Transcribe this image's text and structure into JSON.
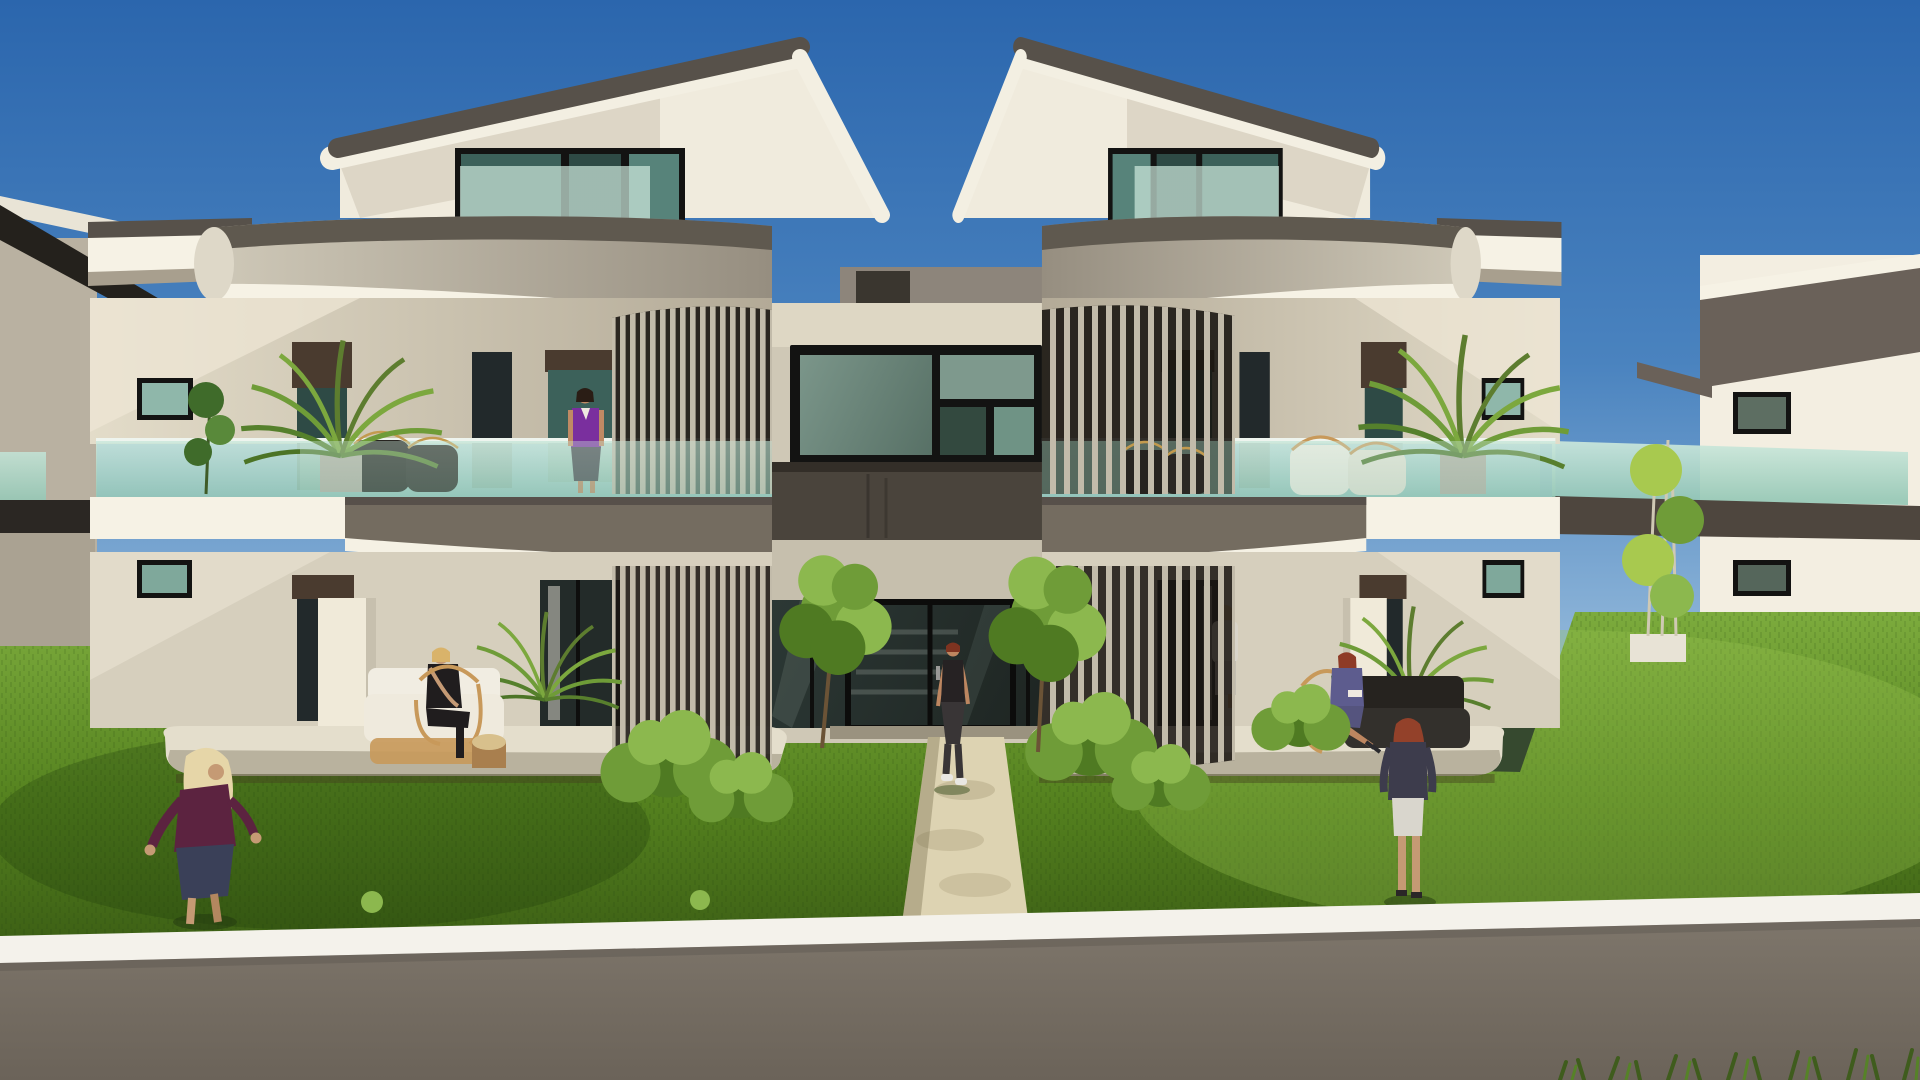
{
  "image": {
    "type": "architectural-3d-rendering",
    "subject": "Modern twin-unit two-storey apartment building with curved balcony bands, vertical slat screens, teal glass balustrades, front lawn, central walkway and boundary wall",
    "time_of_day": "sunny daytime, clear blue sky, sun from the left",
    "view": "front elevation from street behind low boundary wall"
  },
  "colors": {
    "sky_top": "#2b66ad",
    "sky_mid": "#4a83bf",
    "sky_horizon": "#92b8da",
    "roof_dark": "#57514a",
    "roof_shadow_dark": "#24211c",
    "band_light": "#d8d2c1",
    "band_shade": "#968e80",
    "fascia_white": "#f6f2e5",
    "attic_wall": "#f0ebdd",
    "wall_light": "#e3dcc9",
    "wall_shade": "#b3aa97",
    "wall_ground": "#d6cfbd",
    "glass_rail_light": "#cfeade",
    "glass_rail_deep": "#96c8b6",
    "window_dark": "#22292b",
    "window_teal": "#3c615a",
    "glazing_light": "#7e998d",
    "glazing_deep": "#41594f",
    "frame": "#131312",
    "shutter_box": "#4a3b2f",
    "slat": "#c2bbaa",
    "slat_gap": "#17130f",
    "fascia_band": "#746c60",
    "center_band": "#4a443c",
    "lawn_light": "#7fae3f",
    "lawn_mid": "#55821f",
    "lawn_dark": "#3a5c14",
    "path": "#ddd3b2",
    "slab": "#e4decc",
    "slab_face": "#b9b29e",
    "coping": "#f4f2eb",
    "wall_face": "#80786d",
    "wall_face_dark": "#6b6359",
    "bush": "#4f7a22",
    "bush_light": "#8cb84e",
    "leaf": "#6f9c38",
    "trunk": "#6b5336",
    "bamboo": "#a8c94f",
    "pot": "#b5afa2",
    "rattan": "#c8995a",
    "cushion": "#f1ede2",
    "wicker_dark": "#26231f",
    "dark_glass_door": "#1e2522"
  },
  "people": [
    {
      "name": "woman-on-left-balcony",
      "location": "first-floor balcony of left unit",
      "pose": "standing at railing",
      "hair": "#2a1d15",
      "skin": "#c08a64",
      "top": "#7a2f9e",
      "bottom": "#47464d"
    },
    {
      "name": "woman-seated-left-patio",
      "location": "ground-floor patio of left unit",
      "pose": "seated on rattan armchair",
      "hair": "#d9b36a",
      "skin": "#c59a74",
      "top": "#201d1e",
      "bottom": "#201d1e"
    },
    {
      "name": "woman-walking-on-path",
      "location": "central garden walkway",
      "pose": "walking toward viewer",
      "hair": "#7e3320",
      "skin": "#bd8660",
      "top": "#262223",
      "bottom": "#393536",
      "shoes": "#e9e7e3"
    },
    {
      "name": "woman-behind-right-screen",
      "location": "ground floor behind right slat screen",
      "pose": "standing",
      "hair": "#d8be86",
      "skin": "#c59e72",
      "top": "#d8d4ca",
      "bottom": "#c3beb2"
    },
    {
      "name": "woman-seated-right-patio",
      "location": "ground-floor patio of right unit",
      "pose": "seated reading",
      "hair": "#8e3b26",
      "skin": "#bd8660",
      "top": "#5d5c8e",
      "bottom": "#55547e"
    },
    {
      "name": "woman-standing-right-lawn",
      "location": "right lawn near boundary wall",
      "pose": "standing, back turned",
      "hair": "#93412a",
      "skin": "#c59a74",
      "top": "#3d3c4c",
      "bottom": "#d9d6cd"
    },
    {
      "name": "woman-walking-left-lawn",
      "location": "left lawn near boundary wall",
      "pose": "walking right",
      "hair": "#e6d6a8",
      "skin": "#c59a74",
      "top": "#5c2340",
      "bottom": "#3a4058"
    }
  ],
  "vegetation": [
    {
      "name": "palm-left-balcony"
    },
    {
      "name": "palm-right-balcony"
    },
    {
      "name": "yucca-left-patio"
    },
    {
      "name": "palm-right-patio"
    },
    {
      "name": "tree-left-of-path"
    },
    {
      "name": "tree-right-of-path"
    },
    {
      "name": "bush-left-of-path"
    },
    {
      "name": "bush-right-of-path"
    },
    {
      "name": "bamboo-right-gap"
    },
    {
      "name": "leafy-plant-left-wing"
    }
  ]
}
